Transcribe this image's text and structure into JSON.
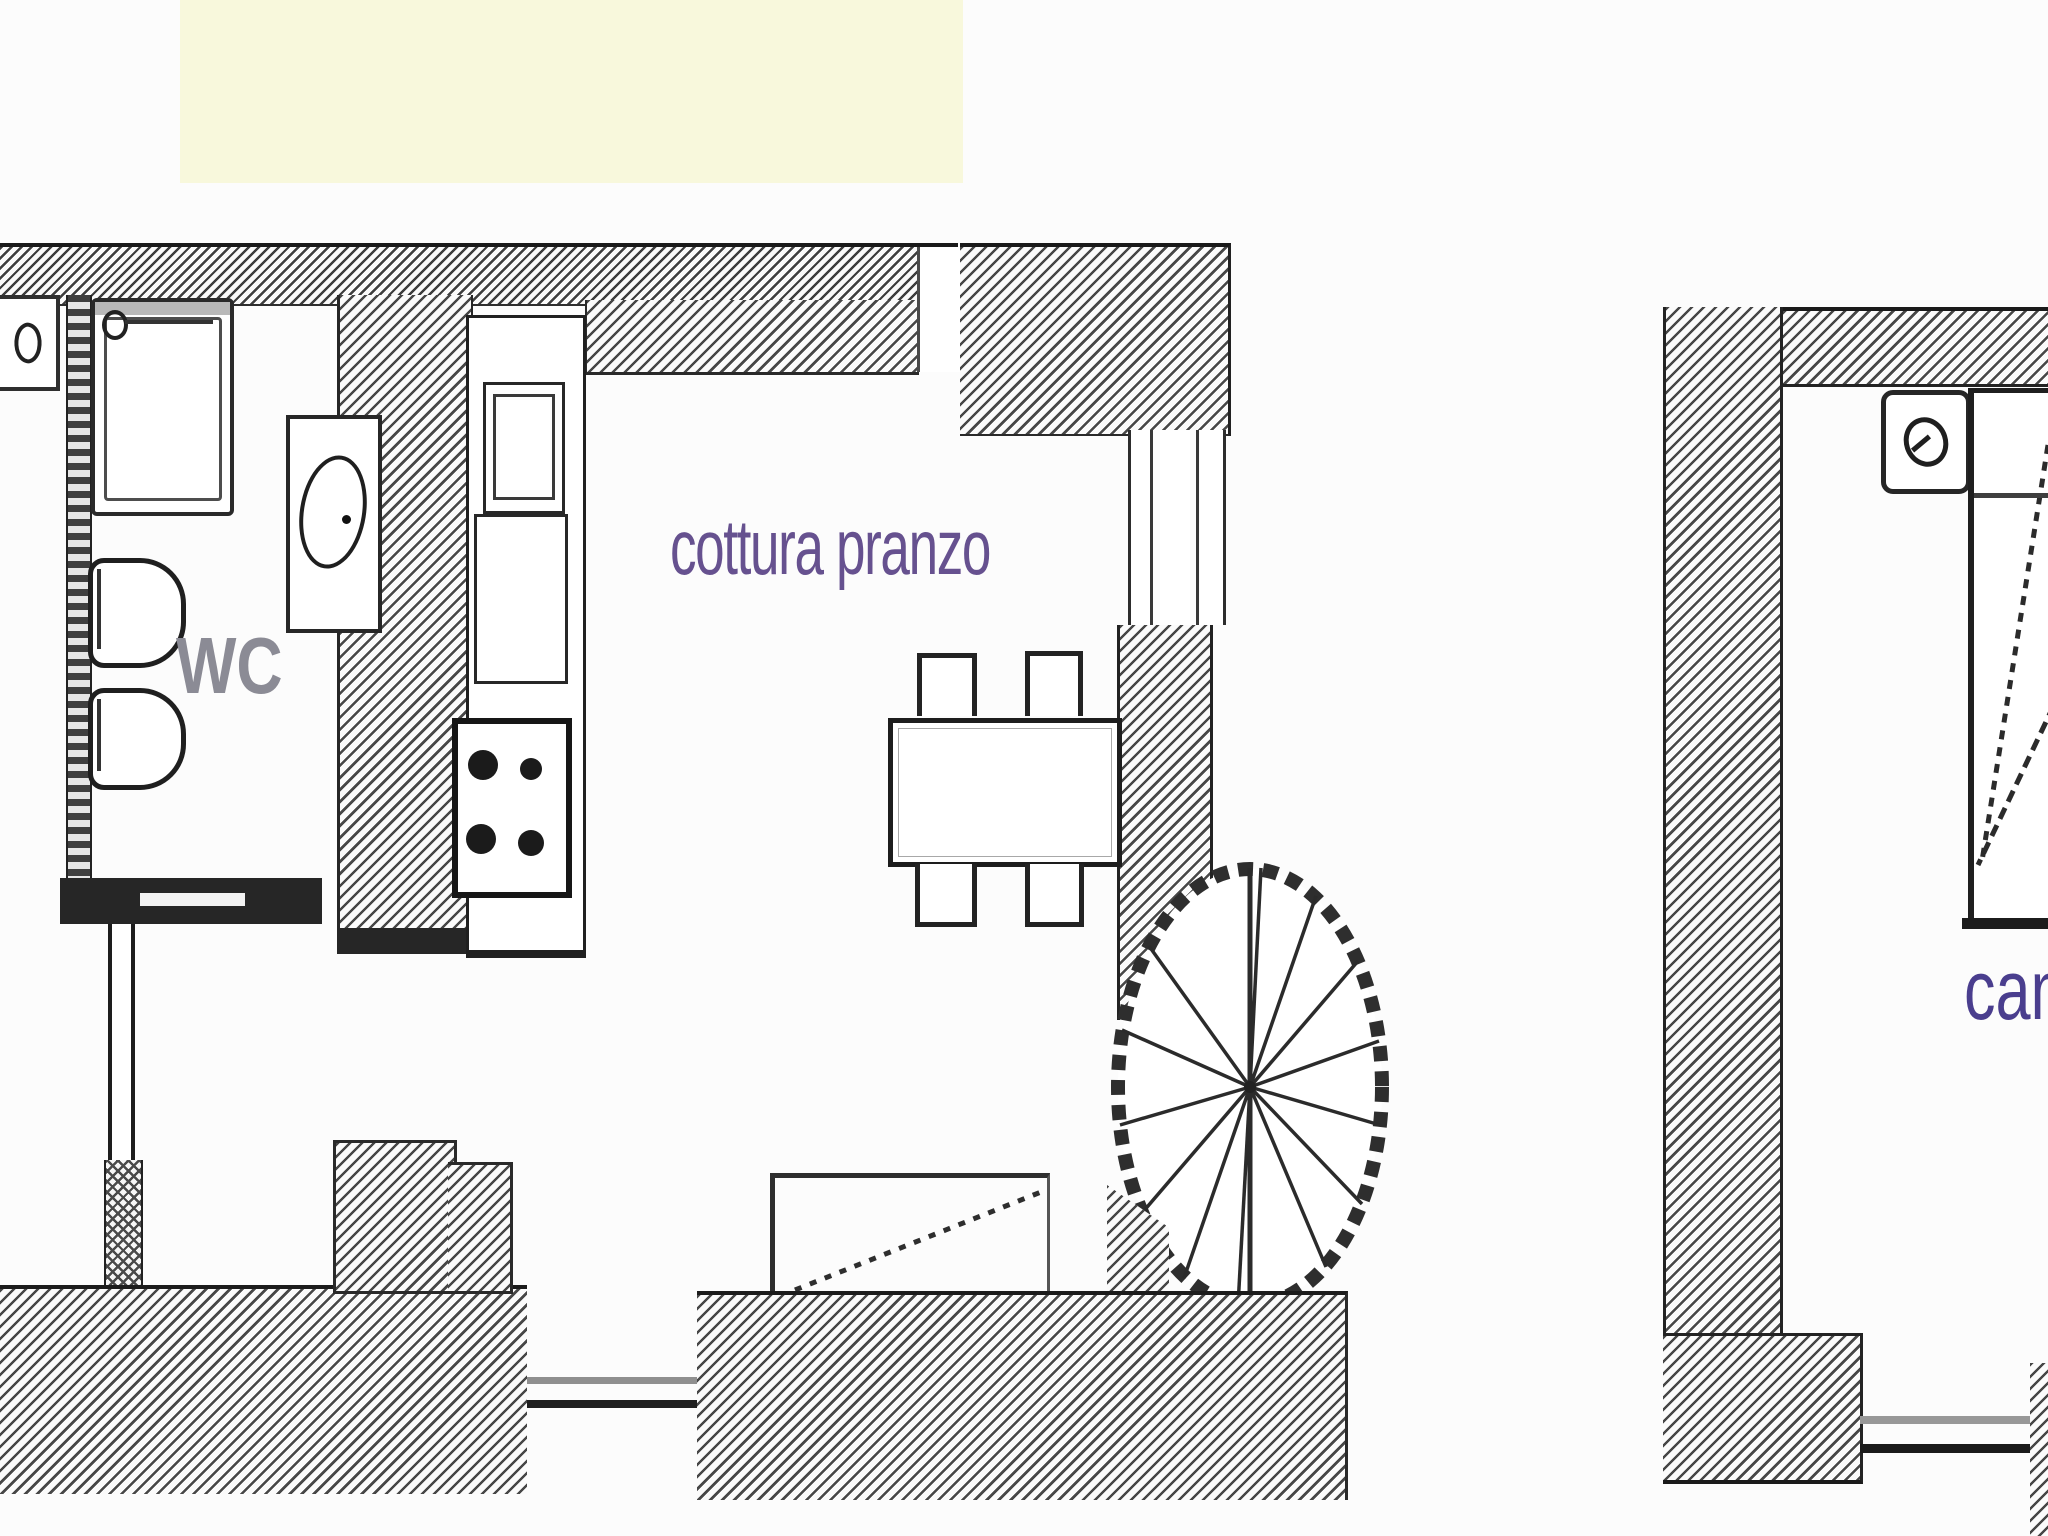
{
  "page": {
    "background_color": "#fcfcfc",
    "top_strip_color": "#f8f8dc"
  },
  "drawing": {
    "type": "apartment floor plan, two levels side by side",
    "wall_line_color": "#1f1f1f",
    "hatch_color": "#474747"
  },
  "floor_plans": {
    "left": {
      "name": "ground-floor-plan",
      "rooms": [
        {
          "id": "wc",
          "label": "WC",
          "label_color": "#8b8b95"
        },
        {
          "id": "kitchen_dining",
          "label": "cottura pranzo",
          "label_color": "#66518f"
        }
      ],
      "fixtures": [
        "door-symbol",
        "shower-tray",
        "faucet",
        "toilet",
        "bidet",
        "washbasin",
        "kitchen-sink",
        "kitchen-unit",
        "stove-4-burners",
        "dining-table",
        "chair",
        "chair",
        "chair",
        "chair",
        "spiral-staircase",
        "ramp-with-dotted-diagonal"
      ]
    },
    "right": {
      "name": "upper-floor-plan",
      "rooms": [
        {
          "id": "bedroom",
          "label": "cam",
          "label_color": "#4a3e8e",
          "note": "truncated at image edge"
        }
      ],
      "fixtures": [
        "door-circle-symbol",
        "bed-with-dashed-diagonals",
        "threshold-double-lines"
      ]
    }
  }
}
